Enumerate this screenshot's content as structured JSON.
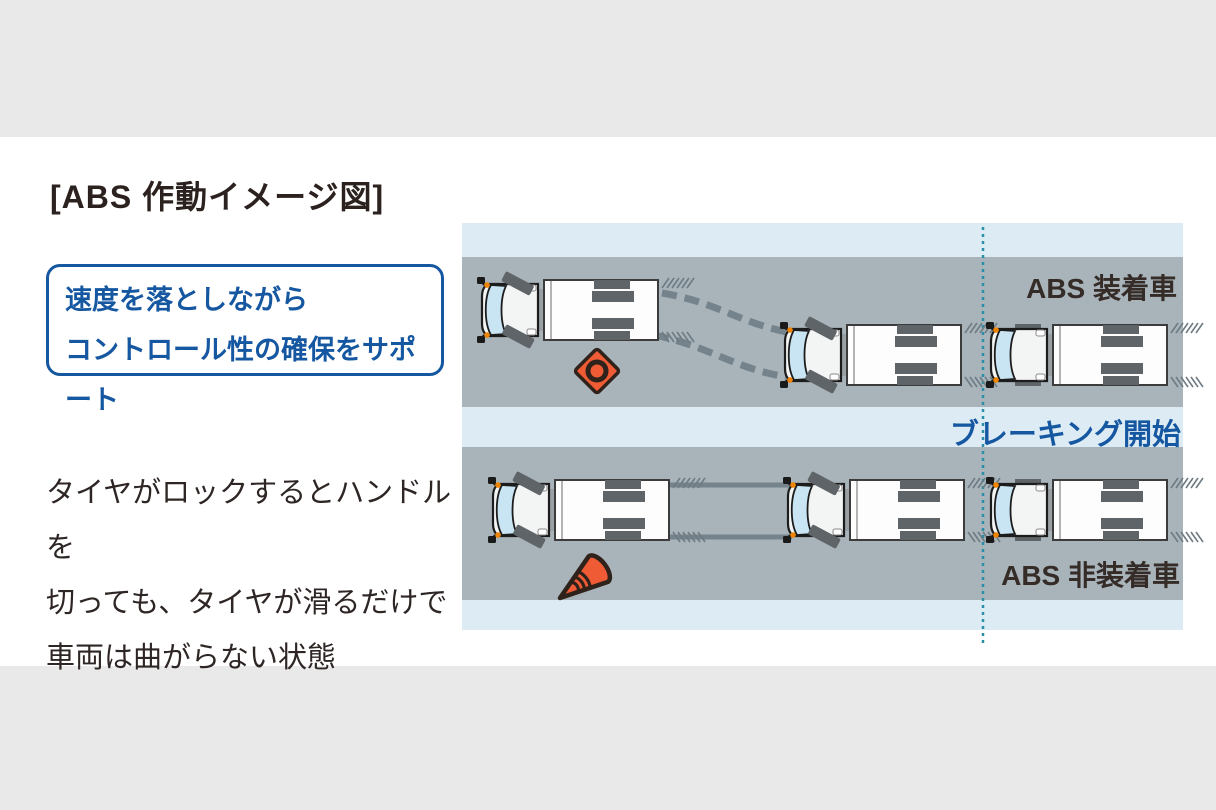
{
  "page": {
    "title": "[ABS 作動イメージ図]"
  },
  "callout": {
    "line1": "速度を落としながら",
    "line2": "コントロール性の確保をサポート"
  },
  "description": {
    "line1": "タイヤがロックするとハンドルを",
    "line2": "切っても、タイヤが滑るだけで",
    "line3": "車両は曲がらない状態"
  },
  "diagram": {
    "abs_label": "ABS 装着車",
    "braking_label": "ブレーキング開始",
    "no_abs_label": "ABS 非装着車"
  },
  "icons": {
    "vehicle": "truck-top-view-icon",
    "obstacle_top": "traffic-cone-top-view-icon",
    "obstacle_bottom": "fallen-traffic-cone-icon",
    "guide_line": "braking-start-guide-line"
  },
  "colors": {
    "accent_blue": "#1557a0",
    "road_gray": "#a8b3ba",
    "sky_blue": "#ddebf5",
    "page_gray": "#e9e9e9",
    "cone_orange": "#ee5b35",
    "guide_teal": "#2a8fa6",
    "text_dark": "#2e2624",
    "track_gray": "#75838c"
  }
}
